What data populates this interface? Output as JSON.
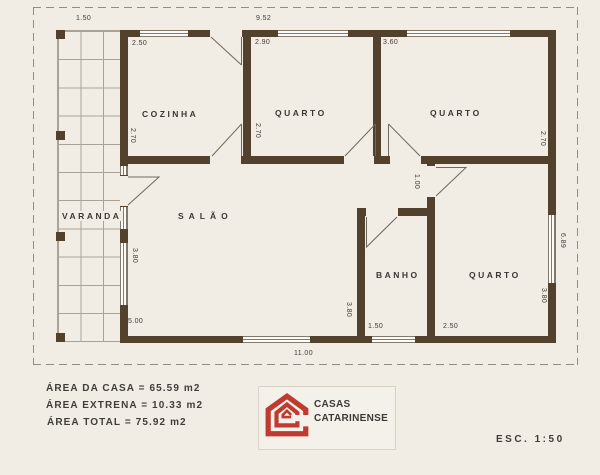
{
  "rooms": {
    "cozinha": "COZINHA",
    "quarto1": "QUARTO",
    "quarto2": "QUARTO",
    "varanda": "VARANDA",
    "salao": "SALÃO",
    "banho": "BANHO",
    "quarto3": "QUARTO"
  },
  "dims": {
    "varanda_width": "1.50",
    "house_top": "9.52",
    "cozinha_w": "2.50",
    "quarto1_w": "2.90",
    "quarto2_w": "3.60",
    "cozinha_d": "2.70",
    "quarto1_d": "2.70",
    "quarto2_d": "2.70",
    "hall_w": "1.00",
    "salao_d": "3.80",
    "banho_d": "3.80",
    "quarto3_d": "3.80",
    "right_side": "6.89",
    "salao_w": "5.00",
    "banho_w": "1.50",
    "quarto3_w": "2.50",
    "house_bottom": "11.00"
  },
  "summary": {
    "lines": [
      "ÁREA DA CASA = 65.59 m2",
      "ÁREA EXTRENA = 10.33 m2",
      "ÁREA TOTAL = 75.92 m2"
    ]
  },
  "logo": {
    "name_line1": "CASAS",
    "name_line2": "CATARINENSE",
    "color": "#bf3a31"
  },
  "scale_label": "ESC. 1:50",
  "colors": {
    "paper": "#f1ede5",
    "wall": "#52412d",
    "thin_line": "#6e675c",
    "grid": "#aaa296",
    "text": "#3f3d39"
  }
}
